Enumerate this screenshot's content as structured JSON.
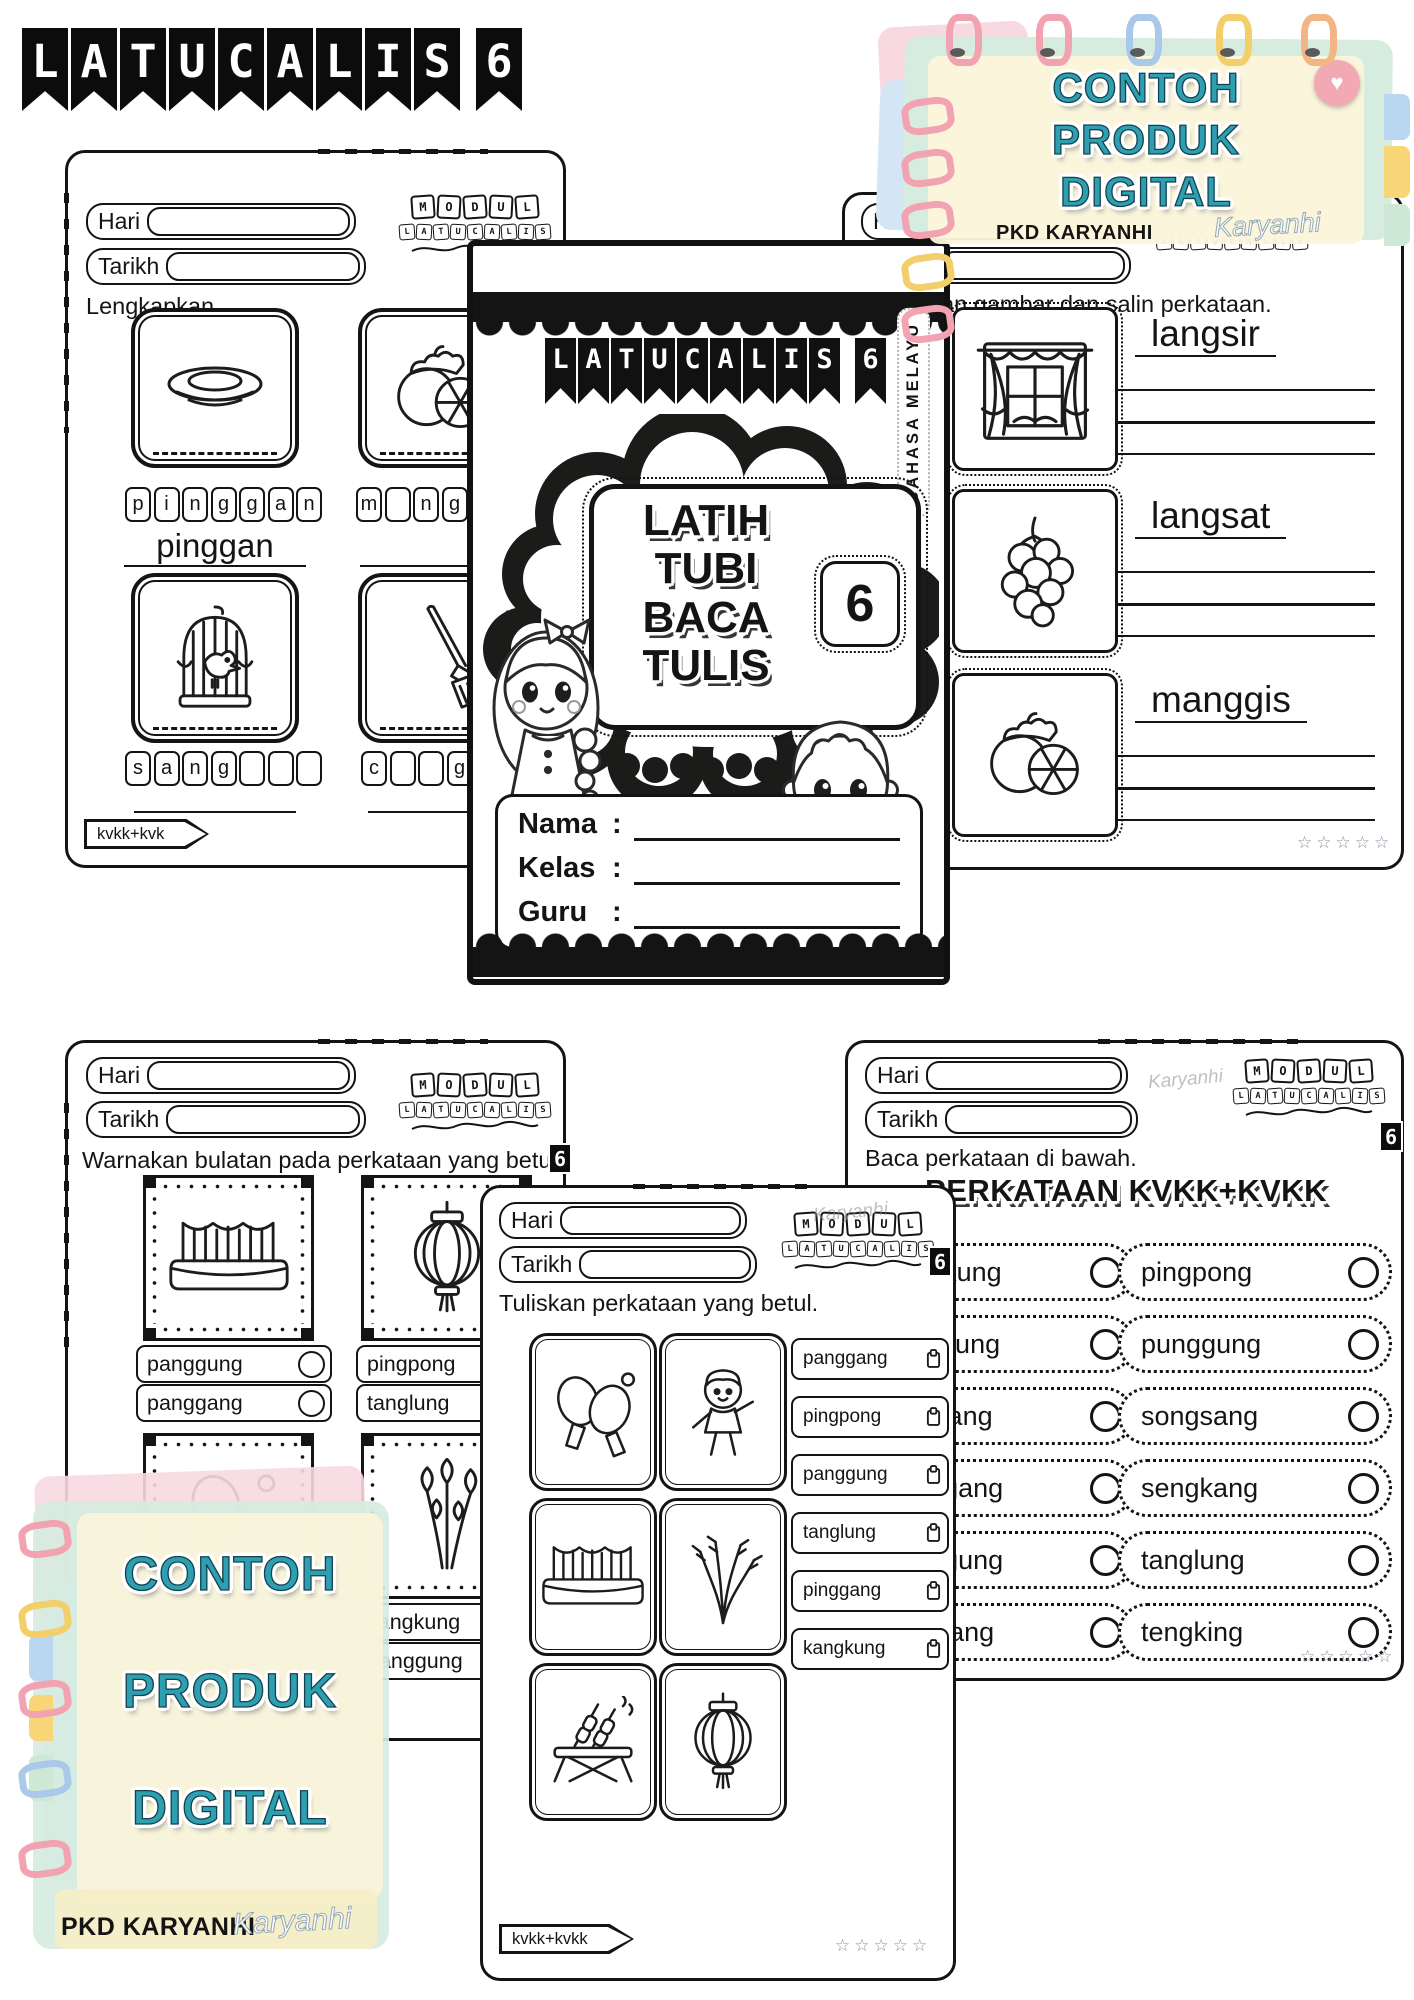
{
  "header": {
    "title": "LATUCALIS",
    "number": "6"
  },
  "note": {
    "lines": [
      "CONTOH",
      "PRODUK",
      "DIGITAL"
    ],
    "brand": "PKD KARYANHI",
    "signature": "Karyanhi"
  },
  "logo": {
    "row1": "MODUL",
    "row2": "LATUCALIS",
    "badge": "6"
  },
  "labels": {
    "hari": "Hari",
    "tarikh": "Tarikh",
    "stars": "☆☆☆☆☆"
  },
  "cover": {
    "banner": "LATUCALIS",
    "banner_number": "6",
    "subject": "BAHASA MELAYU",
    "title_lines": [
      "LATIH",
      "TUBI",
      "BACA",
      "TULIS"
    ],
    "badge": "6",
    "fields": [
      {
        "label": "Nama",
        "sep": ":"
      },
      {
        "label": "Kelas",
        "sep": ":"
      },
      {
        "label": "Guru",
        "sep": ":"
      }
    ]
  },
  "ws_top_left": {
    "instruction": "Lengkapkan.",
    "tab": "kvkk+kvk",
    "items": [
      {
        "image": "plate",
        "boxes": [
          "p",
          "i",
          "n",
          "g",
          "g",
          "a",
          "n"
        ],
        "answer": "pinggan"
      },
      {
        "image": "mangosteen",
        "boxes": [
          "m",
          "",
          "n",
          "g",
          "",
          "",
          ""
        ],
        "answer": ""
      },
      {
        "image": "birdcage",
        "boxes": [
          "s",
          "a",
          "n",
          "g",
          "",
          "",
          ""
        ],
        "answer": ""
      },
      {
        "image": "broom",
        "boxes": [
          "c",
          "",
          "",
          "g",
          "",
          "u",
          ""
        ],
        "answer": ""
      }
    ]
  },
  "ws_top_right": {
    "instruction": "Warnakan gambar dan salin perkataan.",
    "items": [
      {
        "image": "window-curtain",
        "word": "langsir"
      },
      {
        "image": "langsat",
        "word": "langsat"
      },
      {
        "image": "mangosteen",
        "word": "manggis"
      }
    ]
  },
  "ws_bottom_left": {
    "instruction": "Warnakan bulatan pada perkataan yang betul.",
    "tab": "kvkk+kvkk",
    "cards": [
      {
        "image": "stage",
        "options": [
          "panggung",
          "panggang"
        ]
      },
      {
        "image": "lantern",
        "options": [
          "pingpong",
          "tanglung"
        ]
      },
      {
        "image": "pingpong-paddle",
        "options": [
          "pinggang",
          "pingpong"
        ]
      },
      {
        "image": "kangkung",
        "options": [
          "kangkung",
          "panggung"
        ]
      }
    ]
  },
  "ws_bottom_center": {
    "instruction": "Tuliskan perkataan yang betul.",
    "tab": "kvkk+kvkk",
    "images": [
      "pingpong-paddles",
      "boy-exercise",
      "stage",
      "paddy",
      "satay",
      "lantern"
    ],
    "words": [
      "panggang",
      "pingpong",
      "panggung",
      "tanglung",
      "pinggang",
      "kangkung"
    ]
  },
  "ws_bottom_right": {
    "instruction": "Baca perkataan di bawah.",
    "title": "PERKATAAN KVKK+KVKK",
    "left_words": [
      "bengkung",
      "kangkung",
      "longkang",
      "panggang",
      "panggung",
      "pinggang"
    ],
    "right_words": [
      "pingpong",
      "punggung",
      "songsang",
      "sengkang",
      "tanglung",
      "tengking"
    ]
  }
}
